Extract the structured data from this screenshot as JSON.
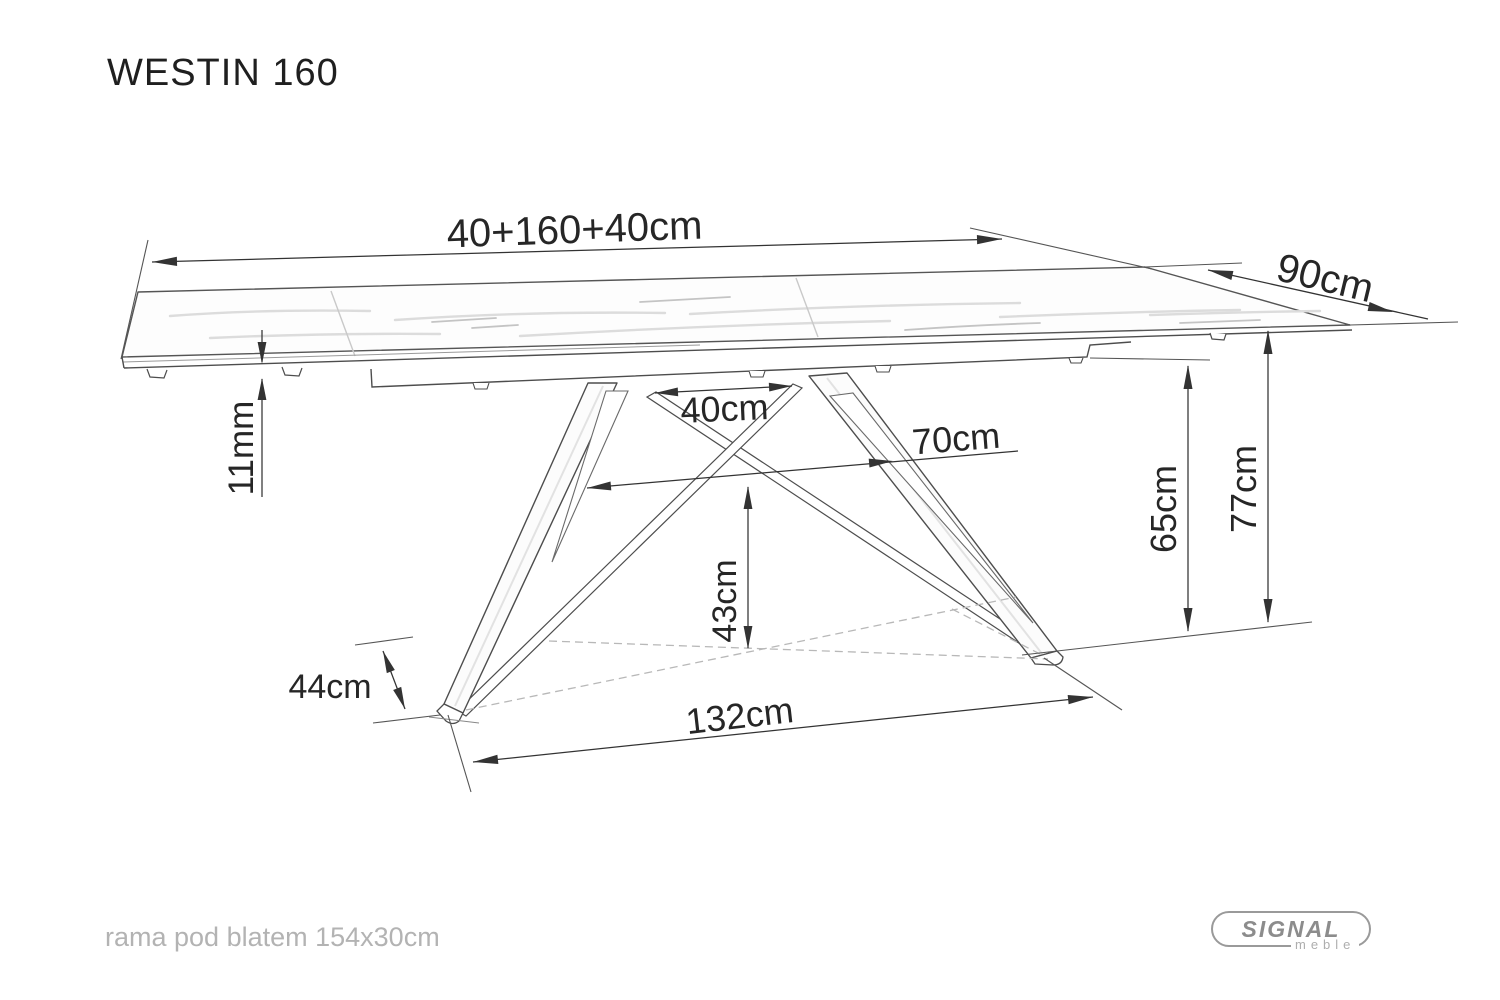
{
  "title": "WESTIN 160",
  "dimensions": {
    "total_length": "40+160+40cm",
    "depth": "90cm",
    "top_thickness": "11mm",
    "leg_top_gap": "40cm",
    "leg_mid_span": "70cm",
    "base_center_height": "43cm",
    "under_frame_height": "65cm",
    "table_height": "77cm",
    "foot_width": "44cm",
    "base_length": "132cm"
  },
  "footer": {
    "note": "rama pod blatem 154x30cm"
  },
  "logo": {
    "brand": "SIGNAL",
    "sub": "meble"
  },
  "colors": {
    "outline": "#4d4d4d",
    "dimension_line": "#333333",
    "dimension_text": "#262626",
    "hidden_dashed": "#b8b8b8",
    "muted_text": "#b3b3b3",
    "logo_gray": "#8c8c8c"
  }
}
